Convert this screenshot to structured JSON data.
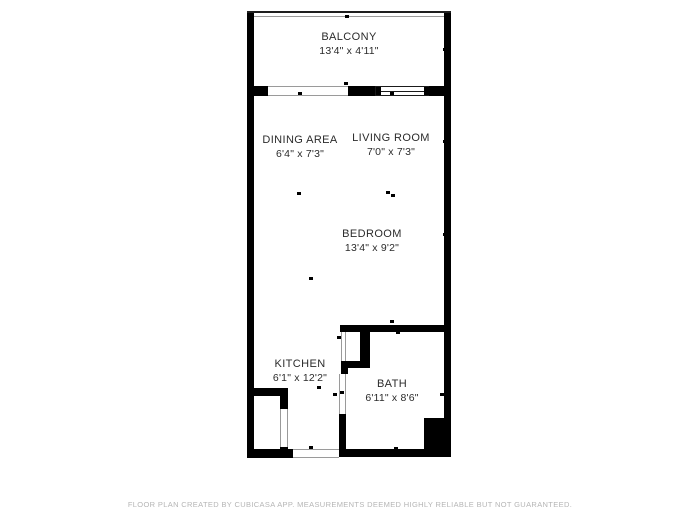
{
  "plan": {
    "background": "#ffffff",
    "wall_color": "#000000",
    "rooms": [
      {
        "name": "BALCONY",
        "dims": "13'4\" x 4'11\""
      },
      {
        "name": "DINING AREA",
        "dims": "6'4\" x 7'3\""
      },
      {
        "name": "LIVING ROOM",
        "dims": "7'0\" x 7'3\""
      },
      {
        "name": "BEDROOM",
        "dims": "13'4\" x 9'2\""
      },
      {
        "name": "KITCHEN",
        "dims": "6'1\" x 12'2\""
      },
      {
        "name": "BATH",
        "dims": "6'11\" x 8'6\""
      }
    ],
    "footer": "FLOOR PLAN CREATED BY CUBICASA APP. MEASUREMENTS DEEMED HIGHLY RELIABLE BUT NOT GUARANTEED."
  }
}
